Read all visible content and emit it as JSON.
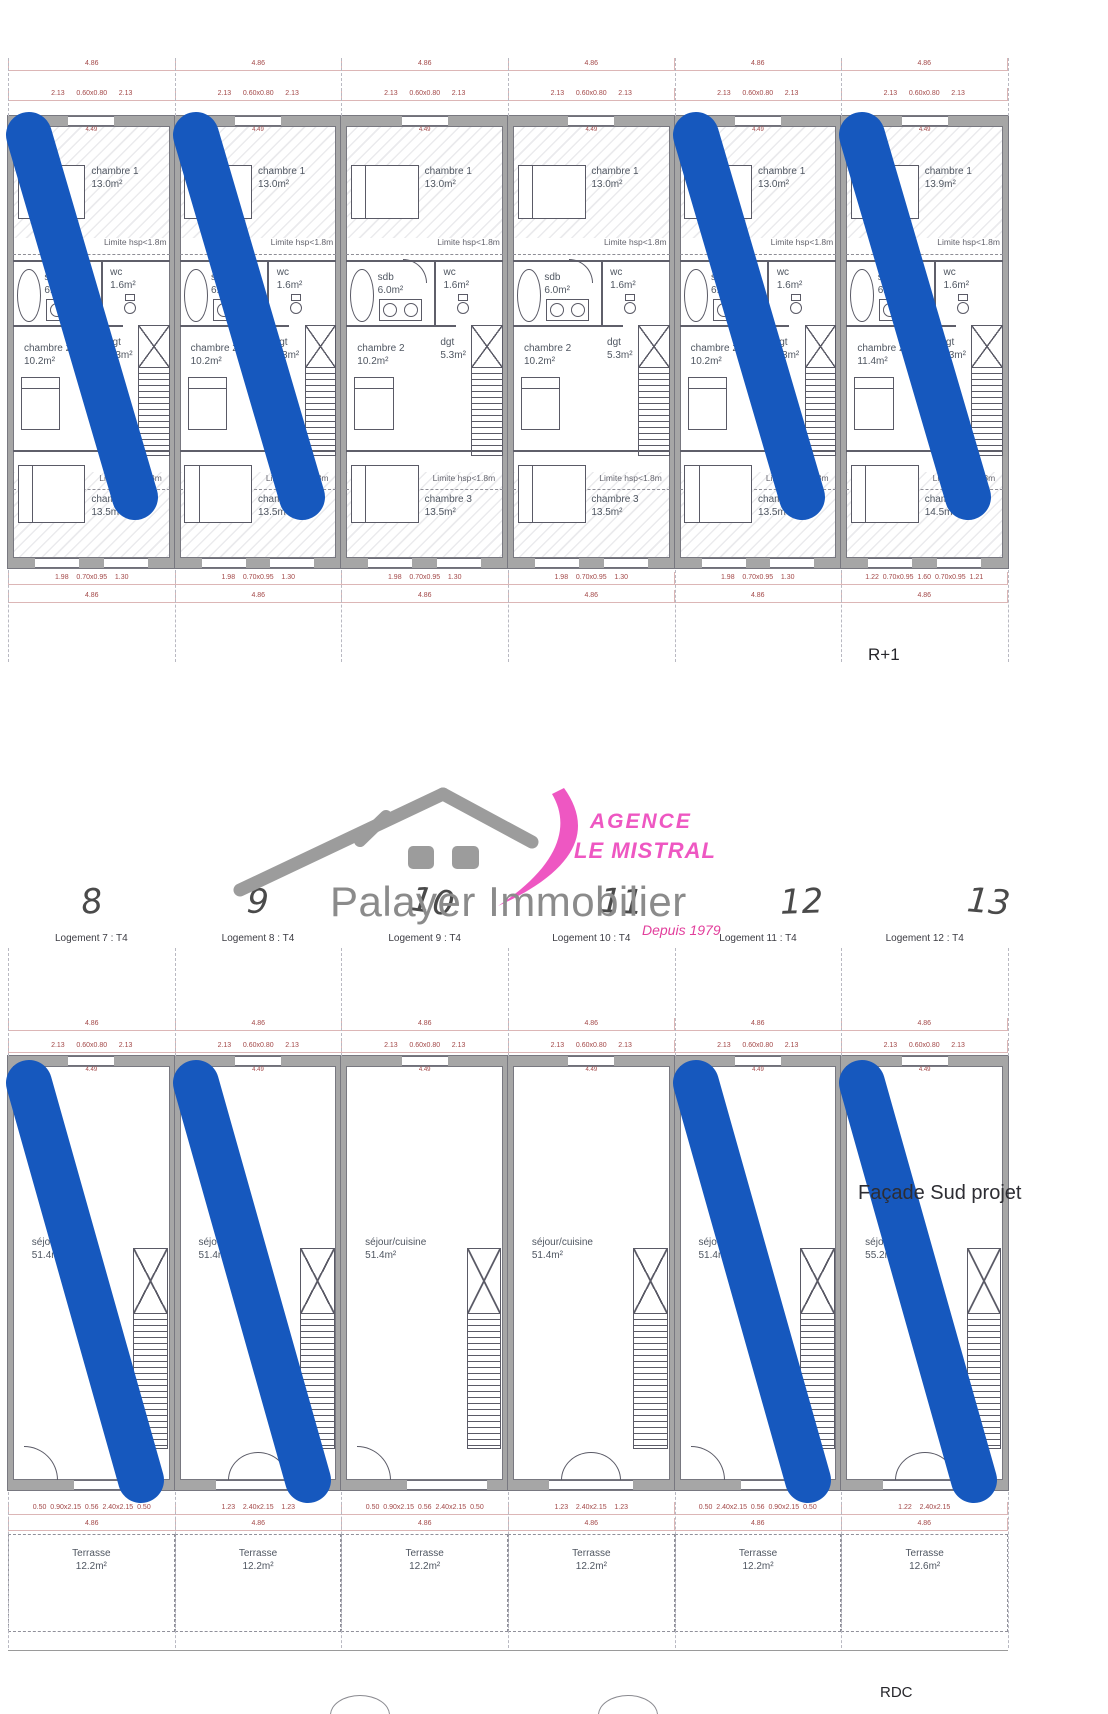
{
  "colors": {
    "stripe_blue": "#1658be",
    "dim_red": "#a34848",
    "wall_gray": "#a6a6a6",
    "logo_pink": "#ee57c2",
    "tagline_pink": "#e23f9c",
    "logo_gray": "#9c9c9c",
    "company_gray": "#8b8b8b"
  },
  "branding": {
    "agence_line1": "AGENCE",
    "agence_line2": "LE MISTRAL",
    "company": "Palayer Immobilier",
    "tagline": "Depuis 1979"
  },
  "annotations": {
    "handwritten_numbers": [
      "8",
      "9",
      "10",
      "11",
      "12",
      "13"
    ],
    "facade_note": "Façade Sud projet",
    "floor_upper_label": "R+1",
    "floor_ground_label": "RDC"
  },
  "logement_labels": [
    "Logement 7 : T4",
    "Logement 8 : T4",
    "Logement 9 : T4",
    "Logement 10 : T4",
    "Logement 11 : T4",
    "Logement 12 : T4"
  ],
  "floor_r1": {
    "dim_width": "4.86",
    "dim_top_splits": "2.13      0.60x0.80      2.13",
    "dim_inner_width": "4.49",
    "dim_bottom_width": "4.86",
    "limite_label": "Limite hsp<1.8m",
    "units": [
      {
        "chambre1_label": "chambre 1",
        "chambre1_area": "13.0m²",
        "sdb_label": "sdb",
        "sdb_area": "6.0m²",
        "wc_label": "wc",
        "wc_area": "1.6m²",
        "chambre2_label": "chambre 2",
        "chambre2_area": "10.2m²",
        "dgt_label": "dgt",
        "dgt_area": "5.3m²",
        "chambre3_label": "chambre 3",
        "chambre3_area": "13.5m²",
        "dim_bottom_splits": "1.98    0.70x0.95    1.30"
      },
      {
        "chambre1_label": "chambre 1",
        "chambre1_area": "13.0m²",
        "sdb_label": "sdb",
        "sdb_area": "6.0m²",
        "wc_label": "wc",
        "wc_area": "1.6m²",
        "chambre2_label": "chambre 2",
        "chambre2_area": "10.2m²",
        "dgt_label": "dgt",
        "dgt_area": "5.3m²",
        "chambre3_label": "chambre 3",
        "chambre3_area": "13.5m²",
        "dim_bottom_splits": "1.98    0.70x0.95    1.30"
      },
      {
        "chambre1_label": "chambre 1",
        "chambre1_area": "13.0m²",
        "sdb_label": "sdb",
        "sdb_area": "6.0m²",
        "wc_label": "wc",
        "wc_area": "1.6m²",
        "chambre2_label": "chambre 2",
        "chambre2_area": "10.2m²",
        "dgt_label": "dgt",
        "dgt_area": "5.3m²",
        "chambre3_label": "chambre 3",
        "chambre3_area": "13.5m²",
        "dim_bottom_splits": "1.98    0.70x0.95    1.30"
      },
      {
        "chambre1_label": "chambre 1",
        "chambre1_area": "13.0m²",
        "sdb_label": "sdb",
        "sdb_area": "6.0m²",
        "wc_label": "wc",
        "wc_area": "1.6m²",
        "chambre2_label": "chambre 2",
        "chambre2_area": "10.2m²",
        "dgt_label": "dgt",
        "dgt_area": "5.3m²",
        "chambre3_label": "chambre 3",
        "chambre3_area": "13.5m²",
        "dim_bottom_splits": "1.98    0.70x0.95    1.30"
      },
      {
        "chambre1_label": "chambre 1",
        "chambre1_area": "13.0m²",
        "sdb_label": "sdb",
        "sdb_area": "6.0m²",
        "wc_label": "wc",
        "wc_area": "1.6m²",
        "chambre2_label": "chambre 2",
        "chambre2_area": "10.2m²",
        "dgt_label": "dgt",
        "dgt_area": "5.3m²",
        "chambre3_label": "chambre 3",
        "chambre3_area": "13.5m²",
        "dim_bottom_splits": "1.98    0.70x0.95    1.30"
      },
      {
        "chambre1_label": "chambre 1",
        "chambre1_area": "13.9m²",
        "sdb_label": "sdb",
        "sdb_area": "6.0m²",
        "wc_label": "wc",
        "wc_area": "1.6m²",
        "chambre2_label": "chambre 2",
        "chambre2_area": "11.4m²",
        "dgt_label": "dgt",
        "dgt_area": "5.3m²",
        "chambre3_label": "chambre 3",
        "chambre3_area": "14.5m²",
        "dim_bottom_splits": "1.22  0.70x0.95  1.60  0.70x0.95  1.21"
      }
    ]
  },
  "floor_rdc": {
    "dim_width": "4.86",
    "dim_top_splits": "2.13      0.60x0.80      2.13",
    "dim_inner_width": "4.49",
    "terrasse_dim_width": "4.86",
    "units": [
      {
        "room": "séjour/cuisine",
        "area": "51.4m²",
        "door": "single",
        "dim_bottom": "0.50  0.90x2.15  0.56  2.40x2.15  0.50",
        "terrasse_label": "Terrasse",
        "terrasse_area": "12.2m²"
      },
      {
        "room": "séjour/cuisine",
        "area": "51.4m²",
        "door": "double",
        "dim_bottom": "1.23    2.40x2.15    1.23",
        "terrasse_label": "Terrasse",
        "terrasse_area": "12.2m²"
      },
      {
        "room": "séjour/cuisine",
        "area": "51.4m²",
        "door": "single",
        "dim_bottom": "0.50  0.90x2.15  0.56  2.40x2.15  0.50",
        "terrasse_label": "Terrasse",
        "terrasse_area": "12.2m²"
      },
      {
        "room": "séjour/cuisine",
        "area": "51.4m²",
        "door": "double",
        "dim_bottom": "1.23    2.40x2.15    1.23",
        "terrasse_label": "Terrasse",
        "terrasse_area": "12.2m²"
      },
      {
        "room": "séjour/cuisine",
        "area": "51.4m²",
        "door": "single",
        "dim_bottom": "0.50  2.40x2.15  0.56  0.90x2.15  0.50",
        "terrasse_label": "Terrasse",
        "terrasse_area": "12.2m²"
      },
      {
        "room": "séjour/cuisine",
        "area": "55.2m²",
        "door": "double",
        "dim_bottom": "1.22    2.40x2.15",
        "terrasse_label": "Terrasse",
        "terrasse_area": "12.6m²"
      }
    ]
  }
}
